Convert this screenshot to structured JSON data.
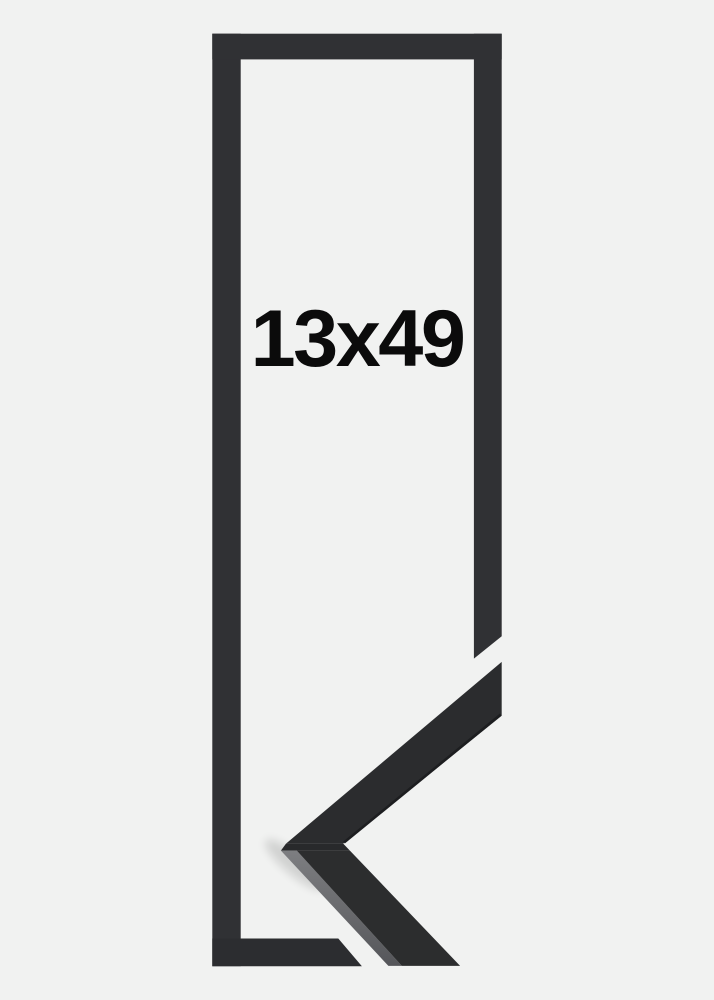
{
  "product": {
    "size_label": "13x49"
  },
  "colors": {
    "background": "#f1f2f1",
    "frame_illustration": "#303134",
    "frame_illustration_bottom": "#2c2d30",
    "sample_top_face": "#2b2c2e",
    "sample_lower_face": "#2c2d2e",
    "sample_seam": "#28292b",
    "sample_under_edge": "#1d1e20",
    "label_text": "#0b0b0b"
  }
}
